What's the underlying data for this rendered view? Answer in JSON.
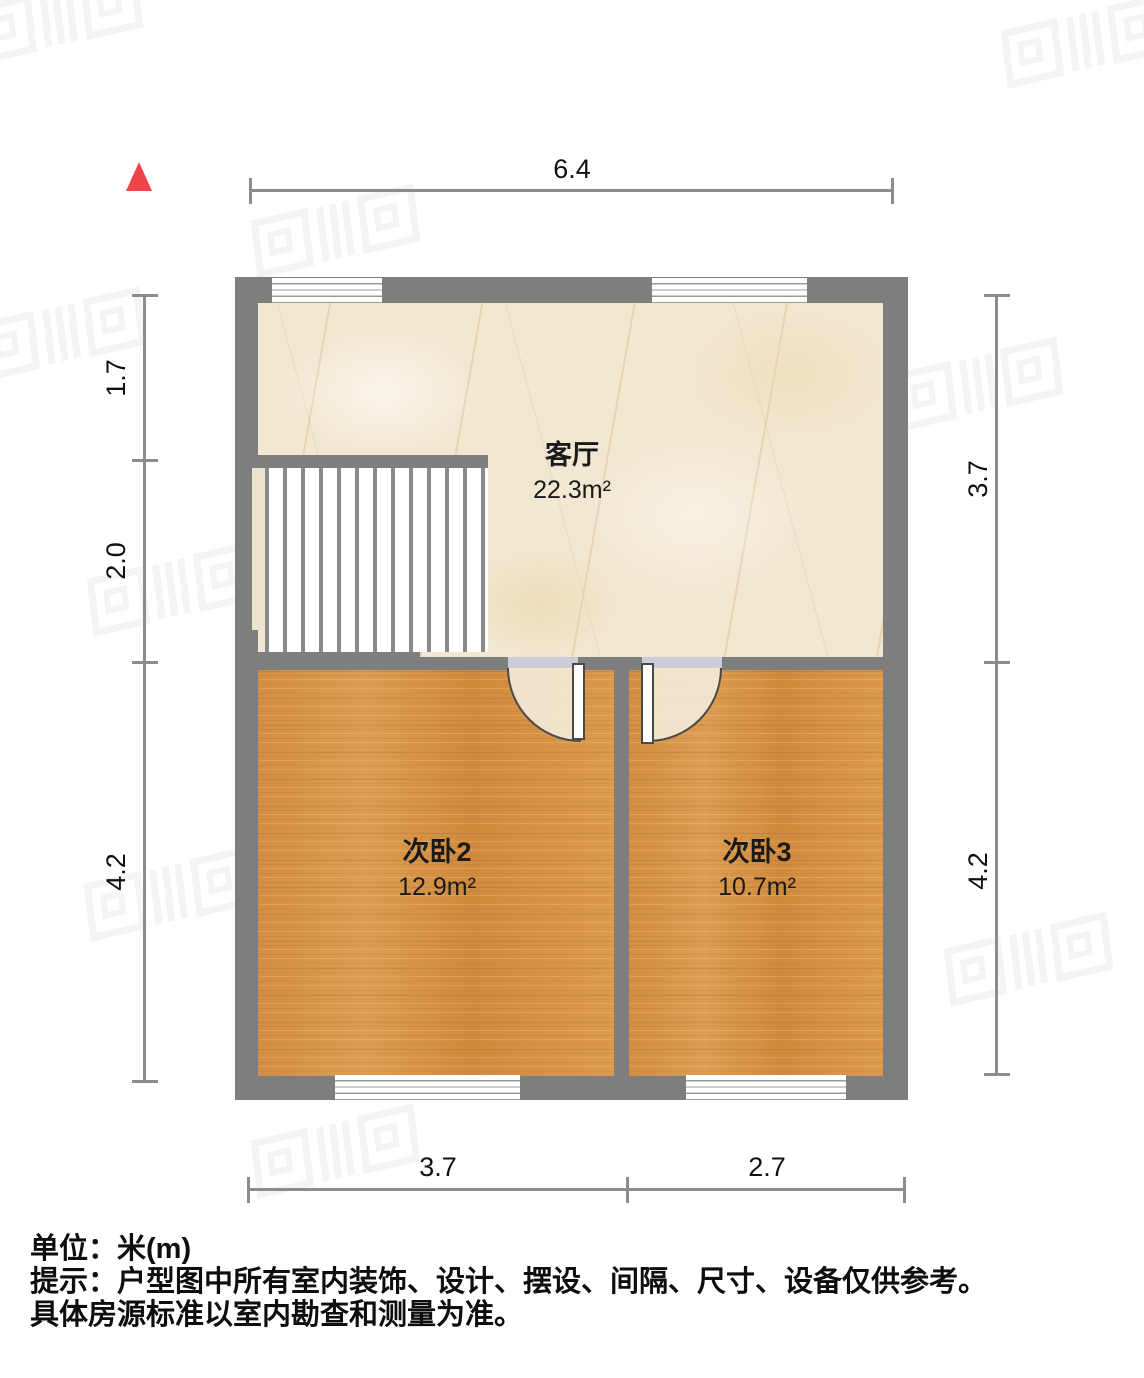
{
  "north_indicator": {
    "icon": "north-triangle",
    "color": "#ee4648"
  },
  "rooms": [
    {
      "name": "客厅",
      "area": "22.3m²"
    },
    {
      "name": "次卧2",
      "area": "12.9m²"
    },
    {
      "name": "次卧3",
      "area": "10.7m²"
    }
  ],
  "dimensions": {
    "top": {
      "total": "6.4"
    },
    "left": {
      "segments": [
        "1.7",
        "2.0",
        "4.2"
      ]
    },
    "right": {
      "segments": [
        "3.7",
        "4.2"
      ]
    },
    "bottom": {
      "segments": [
        "3.7",
        "2.7"
      ]
    }
  },
  "footer": {
    "unit_label": "单位：米(m)",
    "tip_line1": "提示：户型图中所有室内装饰、设计、摆设、间隔、尺寸、设备仅供参考。",
    "tip_line2": "具体房源标准以室内勘查和测量为准。"
  },
  "colors": {
    "wall": "#7e7e7e",
    "living_floor": "#f2e7d1",
    "bedroom_floor": "#d8954a",
    "dimension_line": "#8c8c8c",
    "door_threshold": "#cdcdda"
  }
}
